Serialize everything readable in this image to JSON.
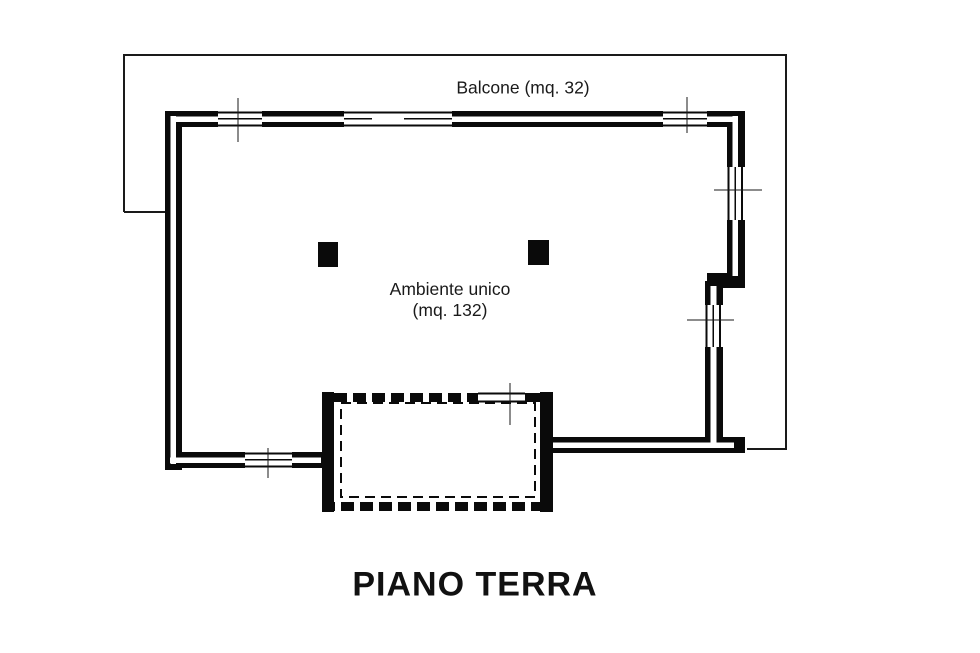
{
  "colors": {
    "ink": "#000000",
    "paper": "#ffffff"
  },
  "plan": {
    "balcony_label": "Balcone (mq. 32)",
    "room_label_line1": "Ambiente unico",
    "room_label_line2": "(mq. 132)",
    "title": "PIANO TERRA"
  }
}
